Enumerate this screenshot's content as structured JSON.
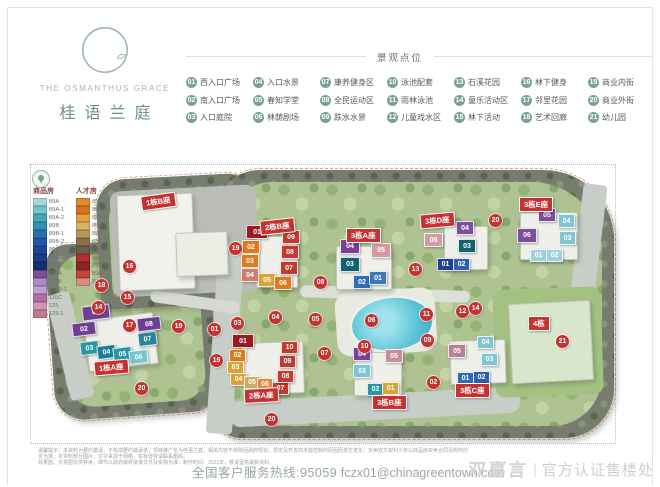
{
  "brand": {
    "en": "THE OSMANTHUS GRACE",
    "cn": "桂语兰庭"
  },
  "legend": {
    "title": "景观点位",
    "items": [
      {
        "num": "01",
        "label": "西入口广场"
      },
      {
        "num": "02",
        "label": "南入口广场"
      },
      {
        "num": "03",
        "label": "入口庭院"
      },
      {
        "num": "04",
        "label": "入口水景"
      },
      {
        "num": "05",
        "label": "春知学堂"
      },
      {
        "num": "06",
        "label": "林荫剧场"
      },
      {
        "num": "07",
        "label": "康养健身区"
      },
      {
        "num": "08",
        "label": "全民运动区"
      },
      {
        "num": "09",
        "label": "跌水水景"
      },
      {
        "num": "10",
        "label": "泳池配套"
      },
      {
        "num": "11",
        "label": "雨林泳池"
      },
      {
        "num": "12",
        "label": "儿童戏水区"
      },
      {
        "num": "13",
        "label": "石溪花园"
      },
      {
        "num": "14",
        "label": "童乐活动区"
      },
      {
        "num": "15",
        "label": "林下活动"
      },
      {
        "num": "16",
        "label": "林下健身"
      },
      {
        "num": "17",
        "label": "邻里花园"
      },
      {
        "num": "18",
        "label": "艺术回廊"
      },
      {
        "num": "19",
        "label": "商业内街"
      },
      {
        "num": "20",
        "label": "商业外街"
      },
      {
        "num": "21",
        "label": "幼儿园"
      }
    ]
  },
  "site": {
    "housing_legend": {
      "commodity_title": "商品房",
      "talent_title": "人才房",
      "commodity": [
        {
          "label": "89A",
          "color": "#a9d8da"
        },
        {
          "label": "89A-1",
          "color": "#74c4c9"
        },
        {
          "label": "89A-2",
          "color": "#45a9b3"
        },
        {
          "label": "89B",
          "color": "#2e8fb9"
        },
        {
          "label": "89B-1",
          "color": "#2a71b1"
        },
        {
          "label": "89B-2",
          "color": "#2456a6"
        },
        {
          "label": "89C",
          "color": "#1d4697"
        },
        {
          "label": "89C-1",
          "color": "#183c87"
        },
        {
          "label": "89E",
          "color": "#133070"
        },
        {
          "label": "115A",
          "color": "#7a4f9e"
        },
        {
          "label": "115B",
          "color": "#a98cc1"
        },
        {
          "label": "115B-1",
          "color": "#bf9fcd"
        },
        {
          "label": "115C",
          "color": "#b06fa3"
        },
        {
          "label": "125",
          "color": "#d294b7"
        },
        {
          "label": "129-1",
          "color": "#c47b90"
        }
      ],
      "talent": [
        {
          "label": "85A-1",
          "color": "#e08a2e"
        },
        {
          "label": "85A-2",
          "color": "#d9731f"
        },
        {
          "label": "85A-3",
          "color": "#e2a43c"
        },
        {
          "label": "85A-4",
          "color": "#d9b268"
        },
        {
          "label": "85B",
          "color": "#b59b55"
        },
        {
          "label": "85C-1",
          "color": "#8a6f4e"
        },
        {
          "label": "85C-2",
          "color": "#6e5e4e"
        },
        {
          "label": "89B",
          "color": "#b03030"
        },
        {
          "label": "89B-1",
          "color": "#8f2525"
        },
        {
          "label": "89A",
          "color": "#c2443a"
        },
        {
          "label": "89A-1",
          "color": "#d98d82"
        }
      ]
    },
    "parcels": [
      {
        "x": 50,
        "y": 240,
        "w": 164,
        "h": 176,
        "rot": -4,
        "radius": "22px 30px 26px 30px"
      },
      {
        "x": 98,
        "y": 176,
        "w": 170,
        "h": 130,
        "rot": -3,
        "radius": "30px 40px 10px 10px"
      },
      {
        "x": 214,
        "y": 170,
        "w": 400,
        "h": 268,
        "rot": 0,
        "radius": "46px 70px 50px 26px"
      }
    ],
    "roads": [
      {
        "x": 112,
        "y": 188,
        "w": 146,
        "h": 106,
        "rot": -3,
        "color": "#b9bdb5",
        "radius": "10px"
      },
      {
        "x": 212,
        "y": 254,
        "w": 26,
        "h": 180,
        "rot": 4,
        "color": "#c9cdc8"
      },
      {
        "x": 230,
        "y": 394,
        "w": 290,
        "h": 26,
        "rot": -3,
        "color": "#c9cdc8",
        "radius": "10px"
      },
      {
        "x": 576,
        "y": 184,
        "w": 24,
        "h": 128,
        "rot": 7,
        "color": "#c9cdc8"
      },
      {
        "x": 150,
        "y": 296,
        "w": 90,
        "h": 12,
        "rot": 8,
        "color": "#d6dad2",
        "radius": "6px"
      },
      {
        "x": 300,
        "y": 288,
        "w": 170,
        "h": 12,
        "rot": 2,
        "color": "#dde0d8",
        "radius": "6px"
      },
      {
        "x": 58,
        "y": 292,
        "w": 24,
        "h": 108,
        "rot": -14,
        "color": "#c9cdc8"
      },
      {
        "x": 336,
        "y": 290,
        "w": 100,
        "h": 64,
        "rot": -4,
        "color": "#e9ebe2",
        "radius": "14px"
      },
      {
        "x": 350,
        "y": 296,
        "w": 80,
        "h": 52,
        "rot": -6,
        "cls": "pool",
        "radius": "50%"
      }
    ],
    "buildings": [
      {
        "x": 118,
        "y": 194,
        "w": 74,
        "h": 94,
        "rot": -2,
        "color": "#f1f2ec"
      },
      {
        "x": 176,
        "y": 232,
        "w": 50,
        "h": 42,
        "rot": -2,
        "color": "#eceee6"
      },
      {
        "x": 256,
        "y": 236,
        "w": 40,
        "h": 50,
        "color": "#eff0ea"
      },
      {
        "x": 336,
        "y": 246,
        "w": 54,
        "h": 42,
        "color": "#eff0ea"
      },
      {
        "x": 444,
        "y": 226,
        "w": 42,
        "h": 42,
        "color": "#eff0ea"
      },
      {
        "x": 520,
        "y": 212,
        "w": 56,
        "h": 46,
        "color": "#eff0ea"
      },
      {
        "x": 494,
        "y": 288,
        "w": 108,
        "h": 108,
        "rot": -2,
        "color": "#a3c282",
        "cls": "lawn"
      },
      {
        "x": 510,
        "y": 302,
        "w": 80,
        "h": 78,
        "rot": -3,
        "color": "#d8e6cc"
      },
      {
        "x": 242,
        "y": 342,
        "w": 60,
        "h": 50,
        "rot": -2,
        "color": "#eff0ea"
      },
      {
        "x": 354,
        "y": 352,
        "w": 46,
        "h": 42,
        "color": "#eff0ea"
      },
      {
        "x": 450,
        "y": 340,
        "w": 54,
        "h": 42,
        "rot": -2,
        "color": "#eff0ea"
      },
      {
        "x": 86,
        "y": 316,
        "w": 68,
        "h": 50,
        "rot": -7,
        "color": "#eff0ea"
      }
    ],
    "banners": [
      {
        "label": "1栋B座",
        "x": 141,
        "y": 194,
        "rot": -8
      },
      {
        "label": "2栋B座",
        "x": 260,
        "y": 219,
        "rot": -6
      },
      {
        "label": "3栋A座",
        "x": 346,
        "y": 228,
        "rot": 0
      },
      {
        "label": "3栋D座",
        "x": 420,
        "y": 213,
        "rot": -5
      },
      {
        "label": "3栋E座",
        "x": 519,
        "y": 197,
        "rot": 0
      },
      {
        "label": "1栋A座",
        "x": 94,
        "y": 360,
        "rot": -5
      },
      {
        "label": "2栋A座",
        "x": 244,
        "y": 388,
        "rot": -3
      },
      {
        "label": "3栋B座",
        "x": 372,
        "y": 395,
        "rot": 0
      },
      {
        "label": "3栋C座",
        "x": 455,
        "y": 383,
        "rot": 0
      },
      {
        "label": "4栋",
        "x": 528,
        "y": 316,
        "rot": 0
      }
    ],
    "markers": [
      {
        "num": "19",
        "x": 229,
        "y": 242
      },
      {
        "num": "13",
        "x": 409,
        "y": 263
      },
      {
        "num": "08",
        "x": 314,
        "y": 276
      },
      {
        "num": "16",
        "x": 123,
        "y": 260
      },
      {
        "num": "18",
        "x": 95,
        "y": 279
      },
      {
        "num": "15",
        "x": 121,
        "y": 291
      },
      {
        "num": "14",
        "x": 92,
        "y": 301
      },
      {
        "num": "17",
        "x": 123,
        "y": 319
      },
      {
        "num": "19",
        "x": 172,
        "y": 320
      },
      {
        "num": "01",
        "x": 208,
        "y": 323
      },
      {
        "num": "03",
        "x": 231,
        "y": 317
      },
      {
        "num": "04",
        "x": 269,
        "y": 311
      },
      {
        "num": "05",
        "x": 309,
        "y": 313
      },
      {
        "num": "06",
        "x": 365,
        "y": 314
      },
      {
        "num": "11",
        "x": 420,
        "y": 308
      },
      {
        "num": "12",
        "x": 456,
        "y": 305
      },
      {
        "num": "14",
        "x": 469,
        "y": 302
      },
      {
        "num": "20",
        "x": 489,
        "y": 214
      },
      {
        "num": "09",
        "x": 421,
        "y": 334
      },
      {
        "num": "10",
        "x": 358,
        "y": 340
      },
      {
        "num": "07",
        "x": 318,
        "y": 347
      },
      {
        "num": "19",
        "x": 210,
        "y": 354
      },
      {
        "num": "02",
        "x": 427,
        "y": 376
      },
      {
        "num": "21",
        "x": 556,
        "y": 335
      },
      {
        "num": "20",
        "x": 135,
        "y": 382
      },
      {
        "num": "20",
        "x": 265,
        "y": 413
      }
    ],
    "units": [
      {
        "num": "01",
        "color": "#6d3f94",
        "x": 82,
        "y": 305,
        "w": 26,
        "h": 13,
        "rot": -7
      },
      {
        "num": "02",
        "color": "#6d3f94",
        "x": 72,
        "y": 322,
        "w": 22,
        "h": 12,
        "rot": -7
      },
      {
        "num": "03",
        "color": "#2a96a5",
        "x": 80,
        "y": 341,
        "w": 17,
        "h": 12,
        "rot": -7
      },
      {
        "num": "04",
        "color": "#1f7d95",
        "x": 97,
        "y": 345,
        "w": 17,
        "h": 12,
        "rot": -7
      },
      {
        "num": "05",
        "color": "#2a96a5",
        "x": 113,
        "y": 347,
        "w": 17,
        "h": 12,
        "rot": -7
      },
      {
        "num": "06",
        "color": "#79c3cc",
        "x": 129,
        "y": 350,
        "w": 17,
        "h": 12,
        "rot": -7
      },
      {
        "num": "07",
        "color": "#27849c",
        "x": 138,
        "y": 332,
        "w": 17,
        "h": 12,
        "rot": -7
      },
      {
        "num": "08",
        "color": "#6d3f94",
        "x": 137,
        "y": 317,
        "w": 22,
        "h": 12,
        "rot": -7
      },
      {
        "num": "01",
        "color": "#991b20",
        "x": 246,
        "y": 225,
        "w": 20,
        "h": 12
      },
      {
        "num": "02",
        "color": "#e07a1f",
        "x": 242,
        "y": 240,
        "w": 16,
        "h": 12
      },
      {
        "num": "03",
        "color": "#e07a1f",
        "x": 241,
        "y": 254,
        "w": 16,
        "h": 12
      },
      {
        "num": "04",
        "color": "#cf7d72",
        "x": 241,
        "y": 268,
        "w": 16,
        "h": 12
      },
      {
        "num": "05",
        "color": "#d9a437",
        "x": 258,
        "y": 273,
        "w": 16,
        "h": 12
      },
      {
        "num": "06",
        "color": "#e07a1f",
        "x": 274,
        "y": 276,
        "w": 16,
        "h": 12
      },
      {
        "num": "07",
        "color": "#c23b2e",
        "x": 280,
        "y": 261,
        "w": 16,
        "h": 12
      },
      {
        "num": "08",
        "color": "#c23b2e",
        "x": 281,
        "y": 245,
        "w": 16,
        "h": 12
      },
      {
        "num": "09",
        "color": "#c23b2e",
        "x": 282,
        "y": 230,
        "w": 16,
        "h": 12
      },
      {
        "num": "04",
        "color": "#7c3f98",
        "x": 340,
        "y": 239,
        "w": 18,
        "h": 13
      },
      {
        "num": "03",
        "color": "#15606e",
        "x": 340,
        "y": 257,
        "w": 18,
        "h": 13
      },
      {
        "num": "02",
        "color": "#2f6db5",
        "x": 353,
        "y": 275,
        "w": 16,
        "h": 12
      },
      {
        "num": "01",
        "color": "#3c78bd",
        "x": 369,
        "y": 271,
        "w": 16,
        "h": 12
      },
      {
        "num": "05",
        "color": "#d49aa4",
        "x": 371,
        "y": 243,
        "w": 18,
        "h": 13
      },
      {
        "num": "05",
        "color": "#d49aa4",
        "x": 424,
        "y": 233,
        "w": 17,
        "h": 12
      },
      {
        "num": "04",
        "color": "#7c4f9e",
        "x": 456,
        "y": 221,
        "w": 16,
        "h": 12
      },
      {
        "num": "03",
        "color": "#15606e",
        "x": 458,
        "y": 239,
        "w": 16,
        "h": 12
      },
      {
        "num": "01",
        "color": "#1f3f8f",
        "x": 437,
        "y": 258,
        "w": 15,
        "h": 11
      },
      {
        "num": "02",
        "color": "#2f5fae",
        "x": 453,
        "y": 258,
        "w": 15,
        "h": 11
      },
      {
        "num": "05",
        "color": "#7c4f9e",
        "x": 538,
        "y": 208,
        "w": 16,
        "h": 12
      },
      {
        "num": "06",
        "color": "#7c4f9e",
        "x": 517,
        "y": 228,
        "w": 18,
        "h": 13
      },
      {
        "num": "04",
        "color": "#7ec5d5",
        "x": 558,
        "y": 214,
        "w": 15,
        "h": 12
      },
      {
        "num": "03",
        "color": "#7ec5d5",
        "x": 559,
        "y": 231,
        "w": 15,
        "h": 12
      },
      {
        "num": "01",
        "color": "#9fd2de",
        "x": 530,
        "y": 249,
        "w": 15,
        "h": 11
      },
      {
        "num": "02",
        "color": "#9fd2de",
        "x": 546,
        "y": 249,
        "w": 15,
        "h": 11
      },
      {
        "num": "01",
        "color": "#991b20",
        "x": 232,
        "y": 334,
        "w": 20,
        "h": 12
      },
      {
        "num": "02",
        "color": "#e07a1f",
        "x": 229,
        "y": 349,
        "w": 15,
        "h": 11
      },
      {
        "num": "03",
        "color": "#d9a437",
        "x": 227,
        "y": 361,
        "w": 15,
        "h": 11
      },
      {
        "num": "04",
        "color": "#d9a437",
        "x": 230,
        "y": 373,
        "w": 15,
        "h": 11
      },
      {
        "num": "05",
        "color": "#c9ad62",
        "x": 244,
        "y": 376,
        "w": 14,
        "h": 11
      },
      {
        "num": "06",
        "color": "#e08a4a",
        "x": 257,
        "y": 378,
        "w": 14,
        "h": 11
      },
      {
        "num": "07",
        "color": "#c23b2e",
        "x": 272,
        "y": 382,
        "w": 15,
        "h": 11
      },
      {
        "num": "08",
        "color": "#c23b2e",
        "x": 277,
        "y": 370,
        "w": 15,
        "h": 11
      },
      {
        "num": "09",
        "color": "#c23b2e",
        "x": 279,
        "y": 355,
        "w": 15,
        "h": 11
      },
      {
        "num": "10",
        "color": "#c23b2e",
        "x": 281,
        "y": 341,
        "w": 15,
        "h": 11
      },
      {
        "num": "04",
        "color": "#7c3f98",
        "x": 353,
        "y": 347,
        "w": 16,
        "h": 12
      },
      {
        "num": "03",
        "color": "#7ec5d5",
        "x": 353,
        "y": 364,
        "w": 16,
        "h": 12
      },
      {
        "num": "02",
        "color": "#2a96a5",
        "x": 367,
        "y": 383,
        "w": 15,
        "h": 11
      },
      {
        "num": "01",
        "color": "#d9a437",
        "x": 382,
        "y": 382,
        "w": 15,
        "h": 11
      },
      {
        "num": "05",
        "color": "#c98e9a",
        "x": 385,
        "y": 349,
        "w": 16,
        "h": 12
      },
      {
        "num": "05",
        "color": "#b5838f",
        "x": 448,
        "y": 344,
        "w": 16,
        "h": 12
      },
      {
        "num": "04",
        "color": "#7ec5d5",
        "x": 477,
        "y": 336,
        "w": 15,
        "h": 11
      },
      {
        "num": "03",
        "color": "#7ec5d5",
        "x": 481,
        "y": 353,
        "w": 15,
        "h": 11
      },
      {
        "num": "01",
        "color": "#2f6db5",
        "x": 457,
        "y": 372,
        "w": 15,
        "h": 11
      },
      {
        "num": "02",
        "color": "#2f5fae",
        "x": 473,
        "y": 371,
        "w": 15,
        "h": 11
      }
    ]
  },
  "footer": {
    "disclaimer_1": "温馨提示：本资料为要约邀请，不构成要约或承诺；项目推广名为桂语兰庭，相关内容不排除因政府规划、规定及开发商未能控制的原因而发生变化；买卖双方权利义务以商品房买卖合同及附件约定为准；本资料部分图片、文字来源于网络，如有侵权请联系删除。",
    "disclaimer_2": "效果图、示意图仅供参考，细节以政府最终批准文件及实物为准；制作时间：2021年，敬请留意最新资料。",
    "service_line": "全国客户服务热线:95059",
    "email": "fczx01@chinagreentown.com",
    "watermark_name": "双嘉言",
    "watermark_divider": "|",
    "watermark_text": "官方认证售楼处"
  }
}
